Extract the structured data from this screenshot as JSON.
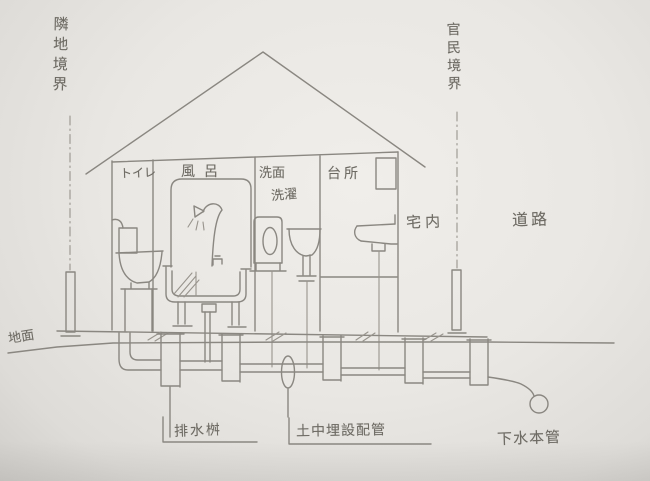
{
  "title": "宅地排水設備断面スケッチ",
  "labels": {
    "boundary_left": "隣地境界",
    "boundary_right": "官民境界",
    "ground": "地面",
    "area_indoor": "宅内",
    "area_road": "道路",
    "room_toilet": "トイレ",
    "room_bath": "風呂",
    "room_wash_face": "洗面",
    "room_laundry": "洗濯",
    "room_kitchen": "台所",
    "drain_basin": "排水桝",
    "buried_pipe": "土中埋設配管",
    "sewer_main": "下水本管"
  },
  "colors": {
    "paper": "#e9e7e3",
    "pencil": "#8a8781",
    "pencil_dark": "#7b7872",
    "text": "#6e6b64"
  },
  "icons": {
    "toilet": "toilet-side-view",
    "bathtub": "bathtub-with-shower",
    "washing_machine": "front-load-washer",
    "washbasin": "pedestal-sink",
    "kitchen_sink": "wall-mounted-sink",
    "drain_basins_count": 5,
    "sewer_main_shape": "pipe-cross-section-circle"
  }
}
